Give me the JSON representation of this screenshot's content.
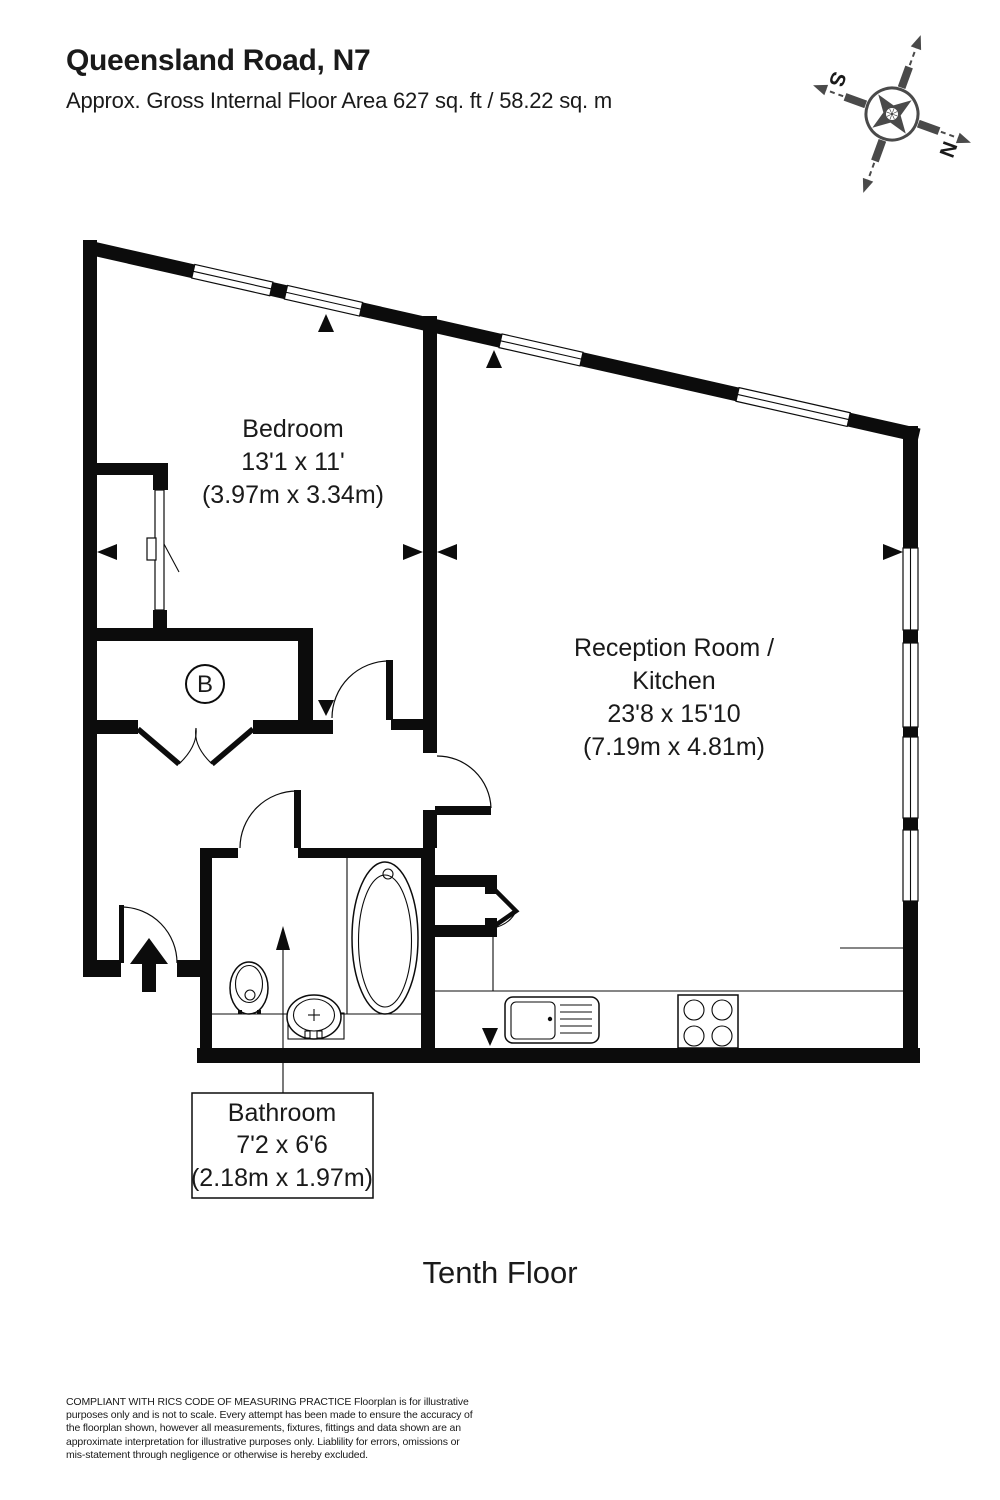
{
  "header": {
    "title": "Queensland Road, N7",
    "subtitle": "Approx. Gross Internal Floor Area 627 sq. ft / 58.22 sq. m"
  },
  "compass": {
    "north_label": "N",
    "south_label": "S"
  },
  "rooms": {
    "bedroom": {
      "name": "Bedroom",
      "dims_imperial": "13'1 x 11'",
      "dims_metric": "(3.97m x 3.34m)"
    },
    "reception": {
      "name_line1": "Reception Room /",
      "name_line2": "Kitchen",
      "dims_imperial": "23'8 x 15'10",
      "dims_metric": "(7.19m x 4.81m)"
    },
    "bathroom": {
      "name": "Bathroom",
      "dims_imperial": "7'2 x 6'6",
      "dims_metric": "(2.18m x 1.97m)"
    },
    "closet_label": "B"
  },
  "floor_label": "Tenth Floor",
  "colors": {
    "wall": "#0c0c0c",
    "compass": "#4a4a4a",
    "background": "#ffffff"
  },
  "disclaimer": {
    "lines": [
      "COMPLIANT WITH RICS CODE OF MEASURING PRACTICE  Floorplan is for illustrative",
      "purposes only and is not to scale. Every attempt has been made to ensure the accuracy of",
      "the floorplan shown, however all measurements, fixtures, fittings and data shown are an",
      "approximate interpretation for illustrative purposes only. Liablility for errors, omissions or",
      "mis-statement through negligence or otherwise is hereby excluded."
    ]
  }
}
